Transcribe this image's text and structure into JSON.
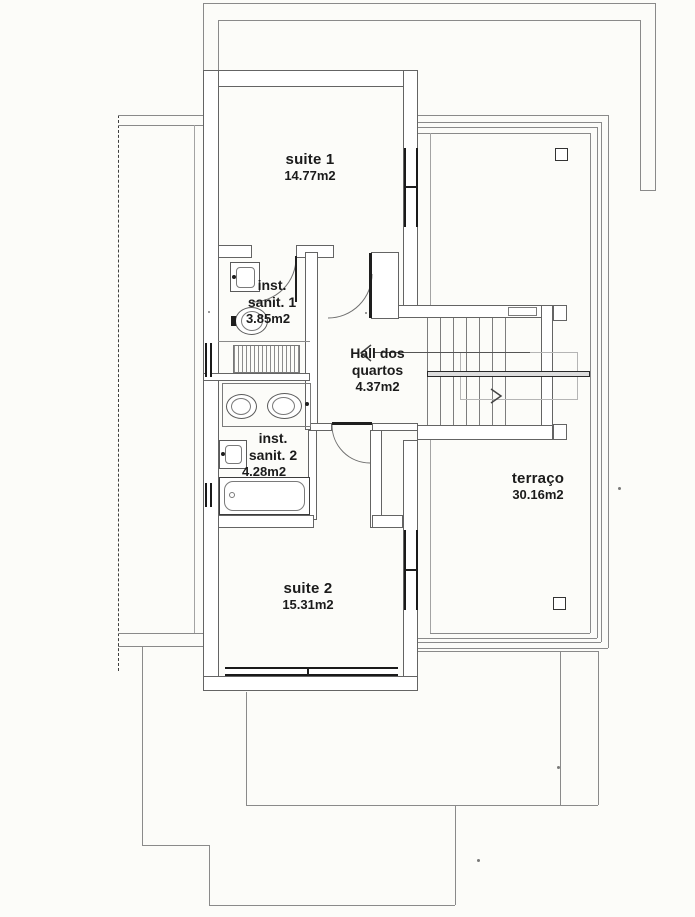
{
  "plan": {
    "kind": "scanned architectural floor plan",
    "colors": {
      "paper": "#fcfcf9",
      "wall_line": "#646464",
      "thin_line": "#8a8a8a",
      "dark_feature": "#1e1e1e",
      "text": "#1b1b1b"
    }
  },
  "rooms": [
    {
      "id": "suite1",
      "label": "suite 1",
      "area": "14.77m2"
    },
    {
      "id": "sanit1",
      "line1": "inst.",
      "line2": "sanit. 1",
      "area": "3.85m2"
    },
    {
      "id": "hall",
      "line1": "Hall dos",
      "line2": "quartos",
      "area": "4.37m2"
    },
    {
      "id": "sanit2",
      "line1": "inst.",
      "line2": "sanit. 2",
      "area": "4.28m2"
    },
    {
      "id": "suite2",
      "label": "suite 2",
      "area": "15.31m2"
    },
    {
      "id": "terraco",
      "label": "terraço",
      "area": "30.16m2"
    }
  ]
}
